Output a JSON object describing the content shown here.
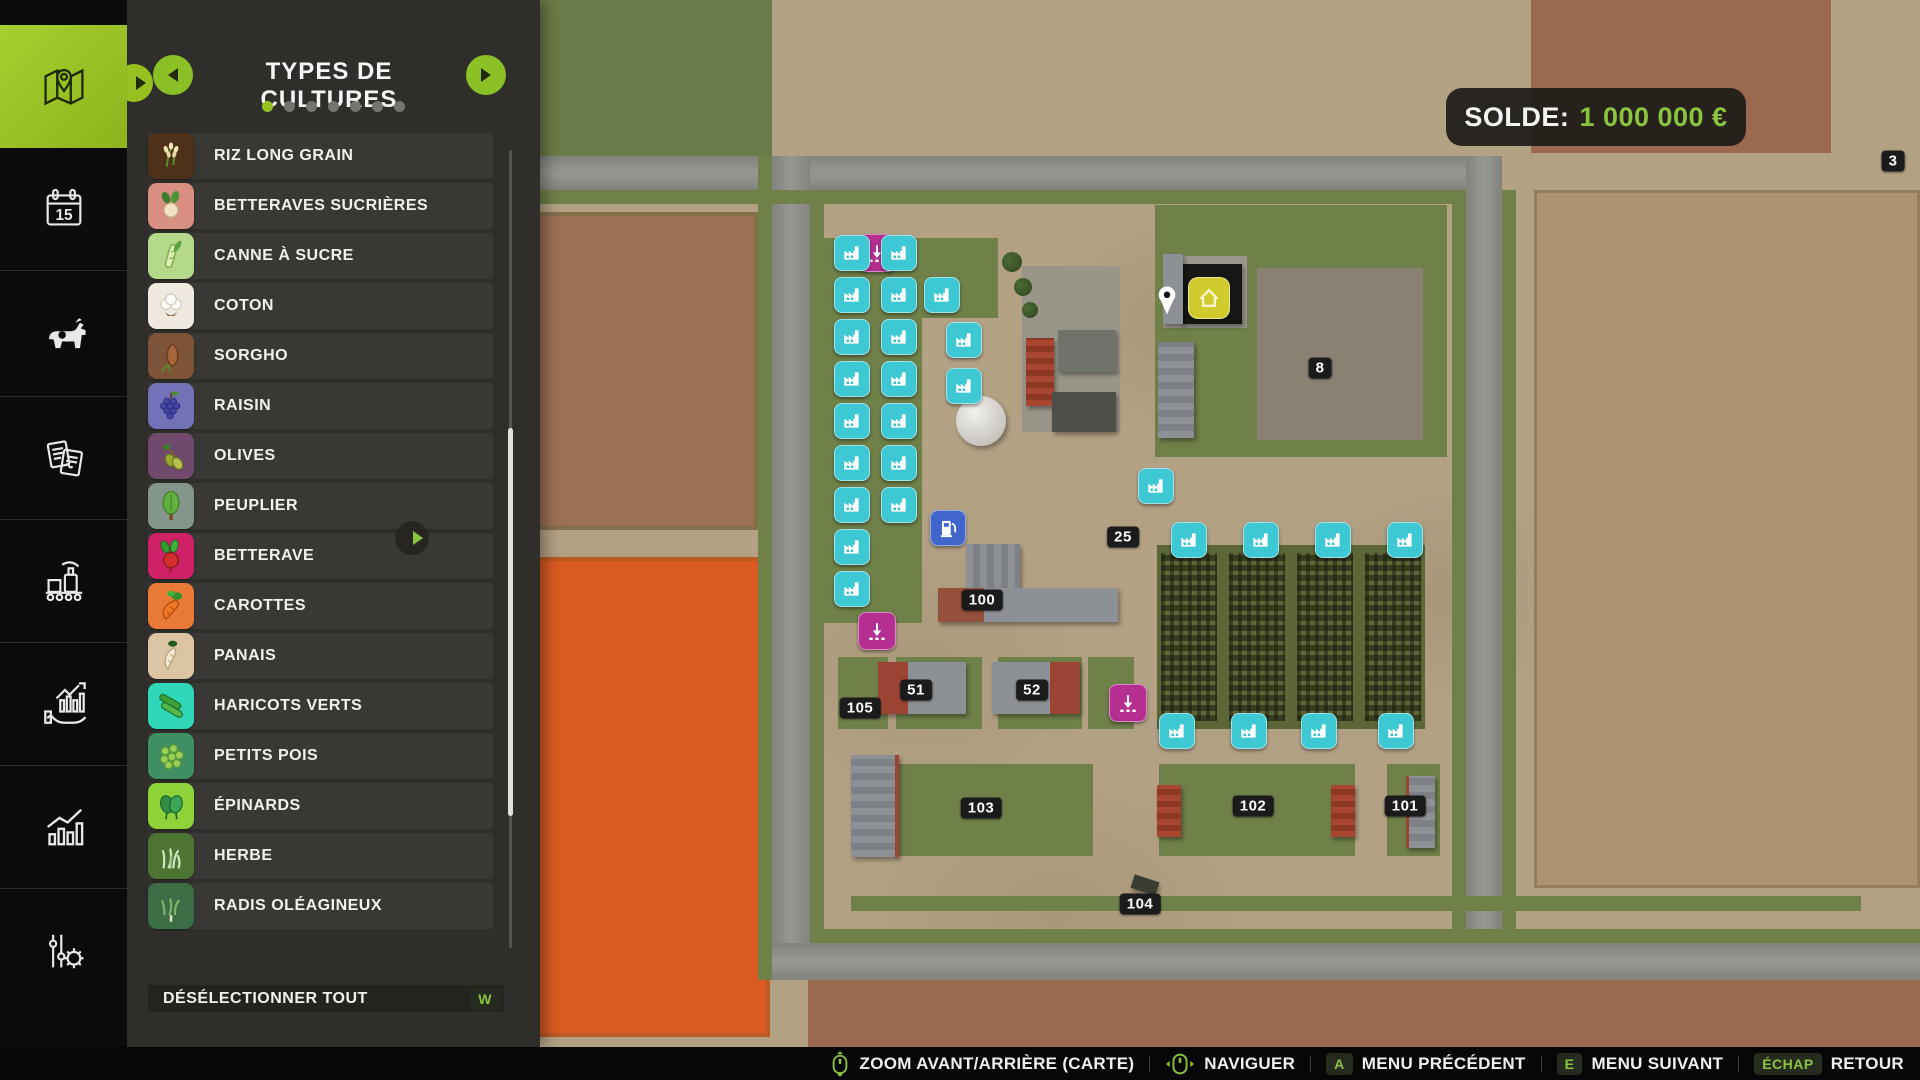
{
  "colors": {
    "accent_green": "#8bc53f",
    "active_tile_green": "#96c121",
    "marker_cyan": "#3ec8d4",
    "marker_magenta": "#b52f92",
    "marker_blue": "#4066cb",
    "marker_yellow": "#cfcb2d",
    "panel_bg": "#2f2e2b",
    "balance_value_green": "#8bc53f"
  },
  "hud": {
    "balance_label": "SOLDE:",
    "balance_value": "1 000 000 €"
  },
  "sidebar": {
    "calendar_day": "15",
    "items": [
      {
        "id": "map",
        "icon": "map-icon",
        "active": true
      },
      {
        "id": "calendar",
        "icon": "calendar-icon",
        "active": false
      },
      {
        "id": "animals",
        "icon": "cow-icon",
        "active": false
      },
      {
        "id": "contracts",
        "icon": "documents-icon",
        "active": false
      },
      {
        "id": "production",
        "icon": "production-icon",
        "active": false
      },
      {
        "id": "finances",
        "icon": "finances-icon",
        "active": false
      },
      {
        "id": "statistics",
        "icon": "statistics-icon",
        "active": false
      },
      {
        "id": "settings",
        "icon": "sliders-gear-icon",
        "active": false
      }
    ]
  },
  "panel": {
    "title": "TYPES DE CULTURES",
    "dots": {
      "count": 7,
      "active_index": 0
    },
    "footer": {
      "label": "DÉSÉLECTIONNER TOUT",
      "key": "W"
    }
  },
  "crops": [
    {
      "label": "RIZ LONG GRAIN",
      "color": "#4f3018"
    },
    {
      "label": "BETTERAVES SUCRIÈRES",
      "color": "#d88e80"
    },
    {
      "label": "CANNE À SUCRE",
      "color": "#b5d98b"
    },
    {
      "label": "COTON",
      "color": "#efe9df"
    },
    {
      "label": "SORGHO",
      "color": "#7d5438"
    },
    {
      "label": "RAISIN",
      "color": "#7272b8"
    },
    {
      "label": "OLIVES",
      "color": "#6f4a6d"
    },
    {
      "label": "PEUPLIER",
      "color": "#83968b"
    },
    {
      "label": "BETTERAVE",
      "color": "#cf2168"
    },
    {
      "label": "CAROTTES",
      "color": "#e97a35"
    },
    {
      "label": "PANAIS",
      "color": "#dcc5a4"
    },
    {
      "label": "HARICOTS VERTS",
      "color": "#2fd6b8"
    },
    {
      "label": "PETITS POIS",
      "color": "#3f8f63"
    },
    {
      "label": "ÉPINARDS",
      "color": "#8ed23a"
    },
    {
      "label": "HERBE",
      "color": "#4d7433"
    },
    {
      "label": "RADIS OLÉAGINEUX",
      "color": "#3c6e45"
    }
  ],
  "map": {
    "badges": [
      {
        "label": "3"
      },
      {
        "label": "8"
      },
      {
        "label": "25"
      },
      {
        "label": "100"
      },
      {
        "label": "51"
      },
      {
        "label": "52"
      },
      {
        "label": "105"
      },
      {
        "label": "103"
      },
      {
        "label": "102"
      },
      {
        "label": "101"
      },
      {
        "label": "104"
      }
    ]
  },
  "bottombar": {
    "items": [
      {
        "icon": "mouse-scroll-icon",
        "label": "ZOOM AVANT/ARRIÈRE (CARTE)"
      },
      {
        "icon": "mouse-pan-icon",
        "label": "NAVIGUER"
      },
      {
        "key": "A",
        "label": "MENU PRÉCÉDENT"
      },
      {
        "key": "E",
        "label": "MENU SUIVANT"
      },
      {
        "key": "ÉCHAP",
        "label": "RETOUR"
      }
    ]
  }
}
